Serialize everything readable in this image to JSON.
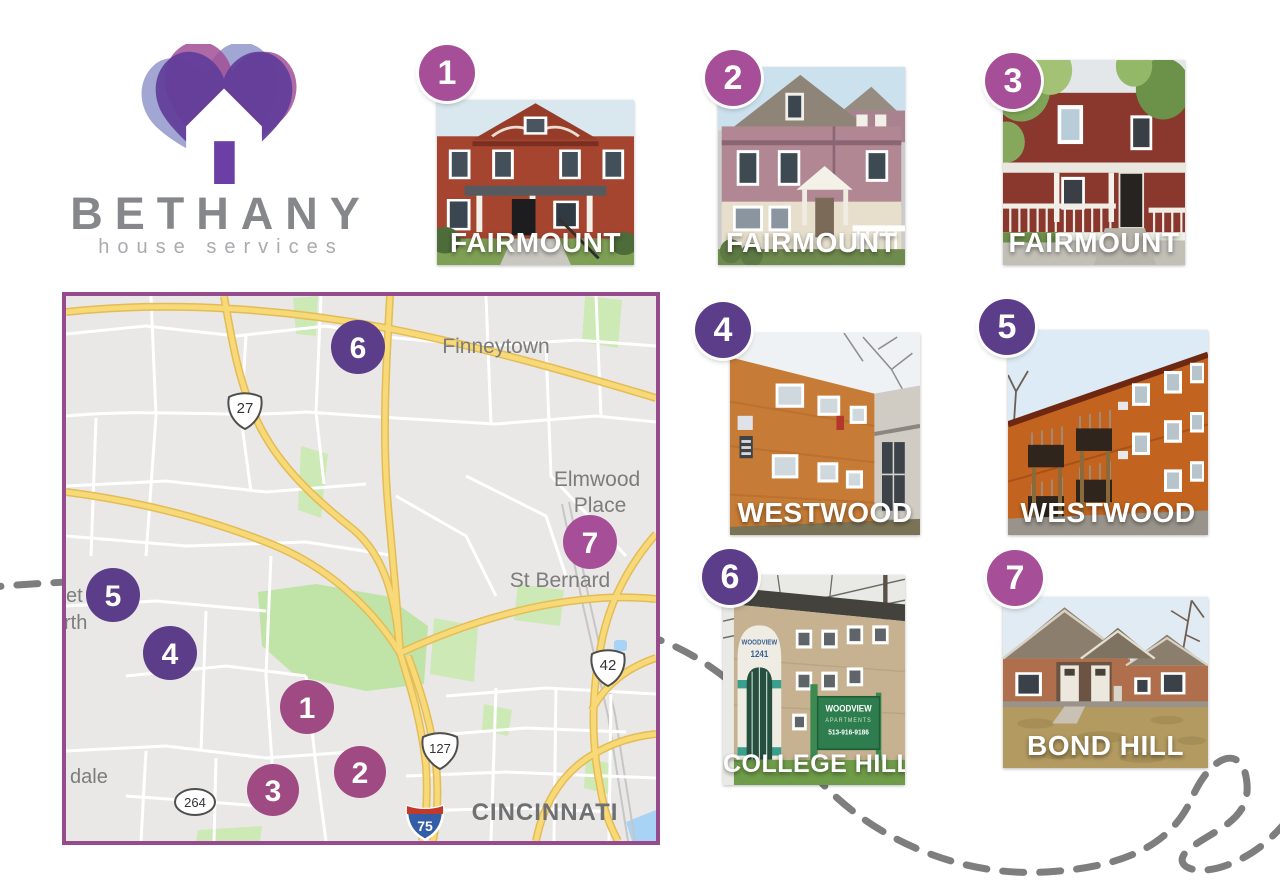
{
  "brand": {
    "name": "BETHANY",
    "tagline": "house services"
  },
  "map": {
    "place_labels": {
      "finneytown": "Finneytown",
      "elmwood_line1": "Elmwood",
      "elmwood_line2": "Place",
      "st_bernard": "St Bernard",
      "cincinnati": "CINCINNATI",
      "edge_partial_1": "et",
      "edge_partial_2": "rth",
      "edge_partial_3": "dale"
    },
    "route_shields": {
      "us_27": "27",
      "us_127": "127",
      "us_42": "42",
      "state_264": "264",
      "interstate_75": "75"
    },
    "markers": [
      {
        "label": "1"
      },
      {
        "label": "2"
      },
      {
        "label": "3"
      },
      {
        "label": "4"
      },
      {
        "label": "5"
      },
      {
        "label": "6"
      },
      {
        "label": "7"
      }
    ]
  },
  "properties": [
    {
      "number": "1",
      "neighborhood": "FAIRMOUNT"
    },
    {
      "number": "2",
      "neighborhood": "FAIRMOUNT"
    },
    {
      "number": "3",
      "neighborhood": "FAIRMOUNT"
    },
    {
      "number": "4",
      "neighborhood": "WESTWOOD"
    },
    {
      "number": "5",
      "neighborhood": "WESTWOOD"
    },
    {
      "number": "6",
      "neighborhood": "COLLEGE HILL",
      "signage": {
        "arch_name": "WOODVIEW",
        "arch_number": "1241",
        "sign_line1": "WOODVIEW",
        "sign_line2": "APARTMENTS",
        "sign_line3": "513-916-9186"
      }
    },
    {
      "number": "7",
      "neighborhood": "BOND HILL"
    }
  ],
  "colors": {
    "marker_purple": "#5b3d89",
    "marker_magenta": "#a64f98",
    "map_border": "#964b8f",
    "highway_yellow": "#f8d978",
    "park_green": "#cde9b6",
    "water_blue": "#a8d3f4",
    "dashed_line_gray": "#7e7e7e",
    "logo_heart_purple": "#5f3d99",
    "logo_heart_periwinkle": "#989ccd",
    "logo_heart_magenta": "#a04f97"
  }
}
